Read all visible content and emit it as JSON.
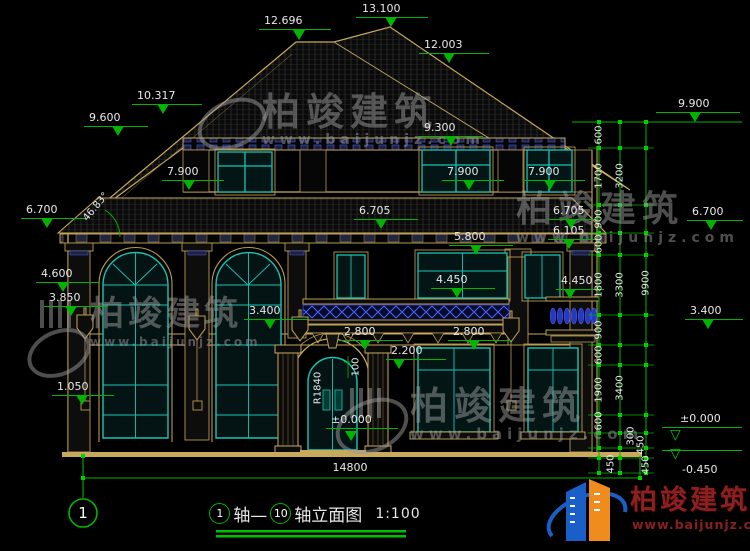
{
  "brand": {
    "name": "柏竣建筑",
    "url": "www.baijunjz.com"
  },
  "drawing": {
    "axis_bubble": "1",
    "title": {
      "axis_start": "1",
      "mid": "轴—",
      "axis_end": "10",
      "suffix": "轴立面图",
      "scale": "1:100"
    },
    "ground_dim": "14800"
  },
  "colors": {
    "background": "#000000",
    "dim_green": "#00b400",
    "outline_tan": "#c9a95c",
    "window_teal": "#19c5b4",
    "accent_blue": "#3448d0",
    "text": "#e8e8e8",
    "logo_blue": "#1a5fc8",
    "logo_orange": "#f08c1e",
    "logo_red": "#8a2020",
    "watermark": "#9c9c9c"
  },
  "elevation_marks": [
    {
      "t": "13.100",
      "tx": 362,
      "ty": 3,
      "lx": 356,
      "ly": 17,
      "lw": 72,
      "mx": 391,
      "my": 27
    },
    {
      "t": "12.696",
      "tx": 264,
      "ty": 15,
      "lx": 259,
      "ly": 29,
      "lw": 72,
      "mx": 299,
      "my": 40
    },
    {
      "t": "12.003",
      "tx": 424,
      "ty": 39,
      "lx": 419,
      "ly": 53,
      "lw": 70,
      "mx": 449,
      "my": 63
    },
    {
      "t": "10.317",
      "tx": 137,
      "ty": 90,
      "lx": 132,
      "ly": 104,
      "lw": 70,
      "mx": 163,
      "my": 114
    },
    {
      "t": "9.600",
      "tx": 89,
      "ty": 112,
      "lx": 84,
      "ly": 126,
      "lw": 64,
      "mx": 118,
      "my": 136
    },
    {
      "t": "9.300",
      "tx": 424,
      "ty": 122,
      "lx": 419,
      "ly": 136,
      "lw": 64,
      "mx": 451,
      "my": 146
    },
    {
      "t": "9.900",
      "tx": 678,
      "ty": 98,
      "lx": 656,
      "ly": 112,
      "lw": 84,
      "mx": 695,
      "my": 122
    },
    {
      "t": "7.900",
      "tx": 167,
      "ty": 166,
      "lx": 162,
      "ly": 180,
      "lw": 62,
      "mx": 189,
      "my": 190
    },
    {
      "t": "7.900",
      "tx": 447,
      "ty": 166,
      "lx": 442,
      "ly": 180,
      "lw": 62,
      "mx": 469,
      "my": 190
    },
    {
      "t": "7.900",
      "tx": 528,
      "ty": 166,
      "lx": 523,
      "ly": 180,
      "lw": 62,
      "mx": 550,
      "my": 190
    },
    {
      "t": "6.700",
      "tx": 26,
      "ty": 204,
      "lx": 21,
      "ly": 218,
      "lw": 64,
      "mx": 47,
      "my": 228
    },
    {
      "t": "6.705",
      "tx": 359,
      "ty": 205,
      "lx": 354,
      "ly": 219,
      "lw": 64,
      "mx": 381,
      "my": 229
    },
    {
      "t": "6.705",
      "tx": 553,
      "ty": 205,
      "lx": 548,
      "ly": 219,
      "lw": 50,
      "mx": 571,
      "my": 229
    },
    {
      "t": "6.700",
      "tx": 692,
      "ty": 206,
      "lx": 687,
      "ly": 220,
      "lw": 56,
      "mx": 711,
      "my": 230
    },
    {
      "t": "6.105",
      "tx": 553,
      "ty": 225,
      "lx": 548,
      "ly": 239,
      "lw": 50,
      "mx": 569,
      "my": 249
    },
    {
      "t": "5.800",
      "tx": 454,
      "ty": 231,
      "lx": 449,
      "ly": 245,
      "lw": 64,
      "mx": 476,
      "my": 255
    },
    {
      "t": "4.600",
      "tx": 41,
      "ty": 268,
      "lx": 36,
      "ly": 282,
      "lw": 64,
      "mx": 63,
      "my": 292
    },
    {
      "t": "4.450",
      "tx": 436,
      "ty": 274,
      "lx": 431,
      "ly": 288,
      "lw": 64,
      "mx": 457,
      "my": 298
    },
    {
      "t": "4.450",
      "tx": 561,
      "ty": 275,
      "lx": 556,
      "ly": 289,
      "lw": 48,
      "mx": 570,
      "my": 299
    },
    {
      "t": "3.850",
      "tx": 49,
      "ty": 292,
      "lx": 44,
      "ly": 306,
      "lw": 64,
      "mx": 71,
      "my": 316
    },
    {
      "t": "3.400",
      "tx": 249,
      "ty": 305,
      "lx": 244,
      "ly": 319,
      "lw": 64,
      "mx": 270,
      "my": 329
    },
    {
      "t": "3.400",
      "tx": 690,
      "ty": 305,
      "lx": 685,
      "ly": 319,
      "lw": 58,
      "mx": 708,
      "my": 329
    },
    {
      "t": "2.800",
      "tx": 344,
      "ty": 326,
      "lx": 339,
      "ly": 340,
      "lw": 64,
      "mx": 365,
      "my": 350
    },
    {
      "t": "2.800",
      "tx": 453,
      "ty": 326,
      "lx": 448,
      "ly": 340,
      "lw": 64,
      "mx": 474,
      "my": 350
    },
    {
      "t": "2.200",
      "tx": 391,
      "ty": 345,
      "lx": 386,
      "ly": 359,
      "lw": 60,
      "mx": 399,
      "my": 369
    },
    {
      "t": "1.050",
      "tx": 57,
      "ty": 381,
      "lx": 52,
      "ly": 395,
      "lw": 62,
      "mx": 82,
      "my": 405
    },
    {
      "t": "±0.000",
      "tx": 331,
      "ty": 414,
      "lx": 326,
      "ly": 428,
      "lw": 72,
      "mx": 351,
      "my": 441
    },
    {
      "t": "±0.000",
      "tx": 680,
      "ty": 413,
      "lx": 662,
      "ly": 427,
      "lw": 80,
      "mx": 677,
      "my": 443,
      "open": 1
    },
    {
      "t": "-0.450",
      "tx": 682,
      "ty": 464,
      "lx": 662,
      "ly": 450,
      "lw": 80,
      "mx": 677,
      "my": 462,
      "open": 1
    }
  ],
  "rotated_labels": [
    {
      "t": "600",
      "x": 599,
      "y": 135
    },
    {
      "t": "1700",
      "x": 599,
      "y": 176
    },
    {
      "t": "900",
      "x": 599,
      "y": 219
    },
    {
      "t": "600",
      "x": 599,
      "y": 244
    },
    {
      "t": "1800",
      "x": 599,
      "y": 285
    },
    {
      "t": "900",
      "x": 599,
      "y": 330
    },
    {
      "t": "600",
      "x": 599,
      "y": 355
    },
    {
      "t": "1900",
      "x": 599,
      "y": 390
    },
    {
      "t": "600",
      "x": 599,
      "y": 421
    },
    {
      "t": "450",
      "x": 611,
      "y": 464
    },
    {
      "t": "3200",
      "x": 620,
      "y": 176
    },
    {
      "t": "3300",
      "x": 620,
      "y": 285
    },
    {
      "t": "3400",
      "x": 620,
      "y": 388
    },
    {
      "t": "300",
      "x": 631,
      "y": 436
    },
    {
      "t": "450",
      "x": 641,
      "y": 445
    },
    {
      "t": "9900",
      "x": 646,
      "y": 283
    },
    {
      "t": "450",
      "x": 646,
      "y": 465
    },
    {
      "t": "R1840",
      "x": 318,
      "y": 388
    },
    {
      "t": "100",
      "x": 356,
      "y": 367
    },
    {
      "t": "46.83°",
      "x": 96,
      "y": 207,
      "rot": -50
    }
  ]
}
